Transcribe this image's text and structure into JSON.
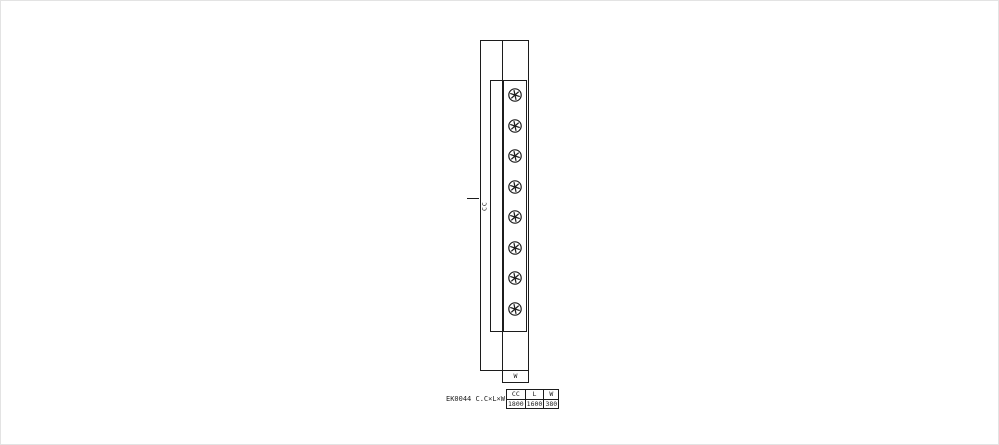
{
  "drawing": {
    "title": "EK0044 C.C×L×W",
    "cc_label": "CC",
    "w_label": "W",
    "screw_count": 8
  },
  "dimension_table": {
    "headers": [
      "CC",
      "L",
      "W"
    ],
    "values": [
      "1800",
      "1600",
      "380"
    ]
  },
  "colors": {
    "line": "#1c1c1c",
    "background": "#ffffff"
  }
}
